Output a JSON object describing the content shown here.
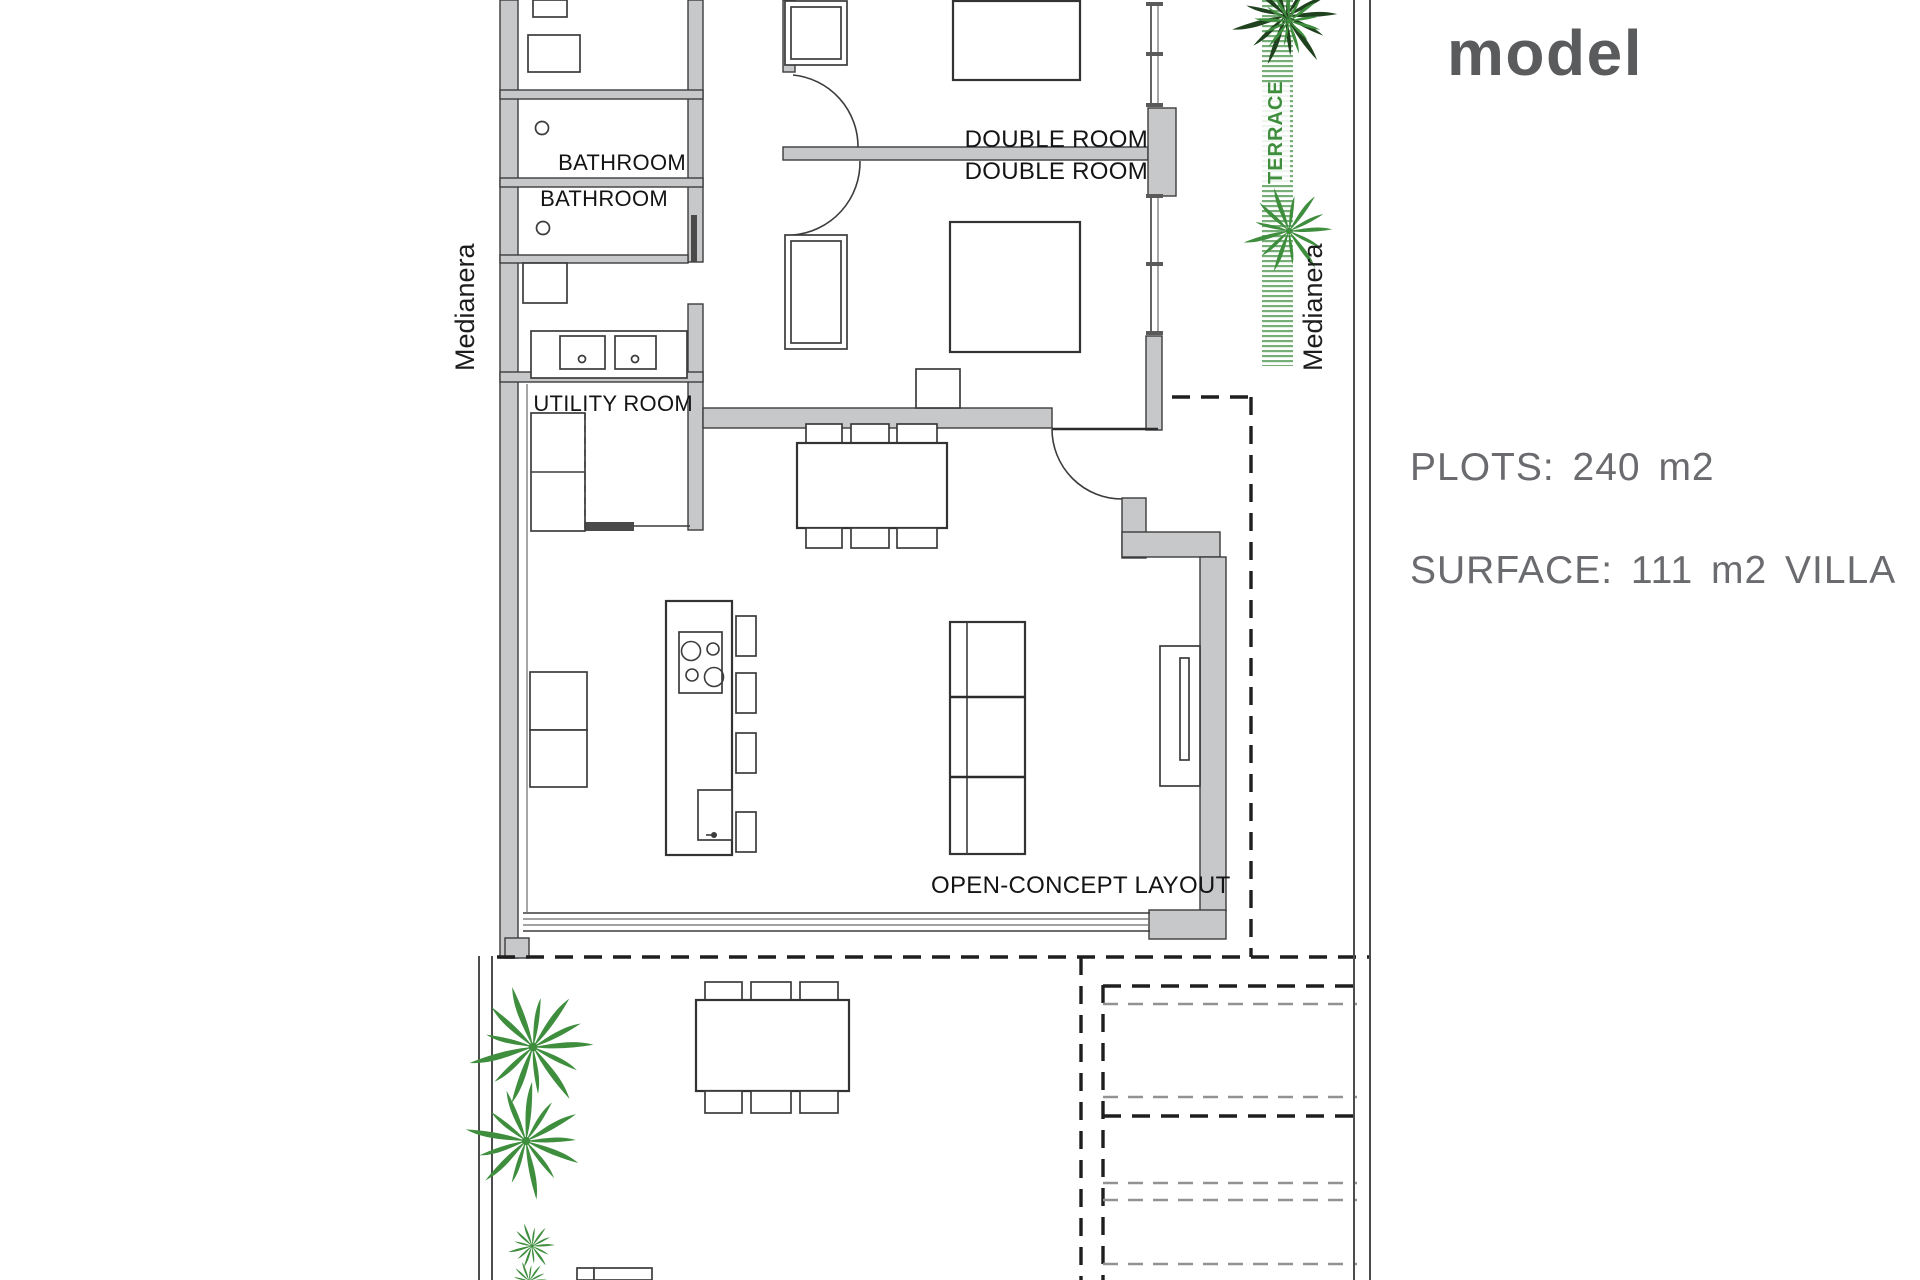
{
  "header": {
    "title_line1": "Ground floor",
    "title_line2": "model",
    "plots": "PLOTS: 240 m2",
    "surface": "SURFACE: 111 m2 VILLA"
  },
  "plan": {
    "rooms": {
      "bathroom_1": "BATHROOM",
      "bathroom_2": "BATHROOM",
      "utility_room": "UTILITY ROOM",
      "double_room_1": "DOUBLE ROOM",
      "double_room_2": "DOUBLE ROOM",
      "open_concept": "OPEN-CONCEPT LAYOUT"
    },
    "boundaries": {
      "medianera_left": "Medianera",
      "medianera_right": "Medianera",
      "terrace": "TERRACE"
    }
  },
  "colors": {
    "wall_fill": "#c7c8ca",
    "title_gray": "#5a5b5d",
    "text_gray": "#6a6b6e",
    "plant_green": "#3e8e3e",
    "plant_dark": "#20421f",
    "terrace_hatch": "#5f9f5f"
  }
}
